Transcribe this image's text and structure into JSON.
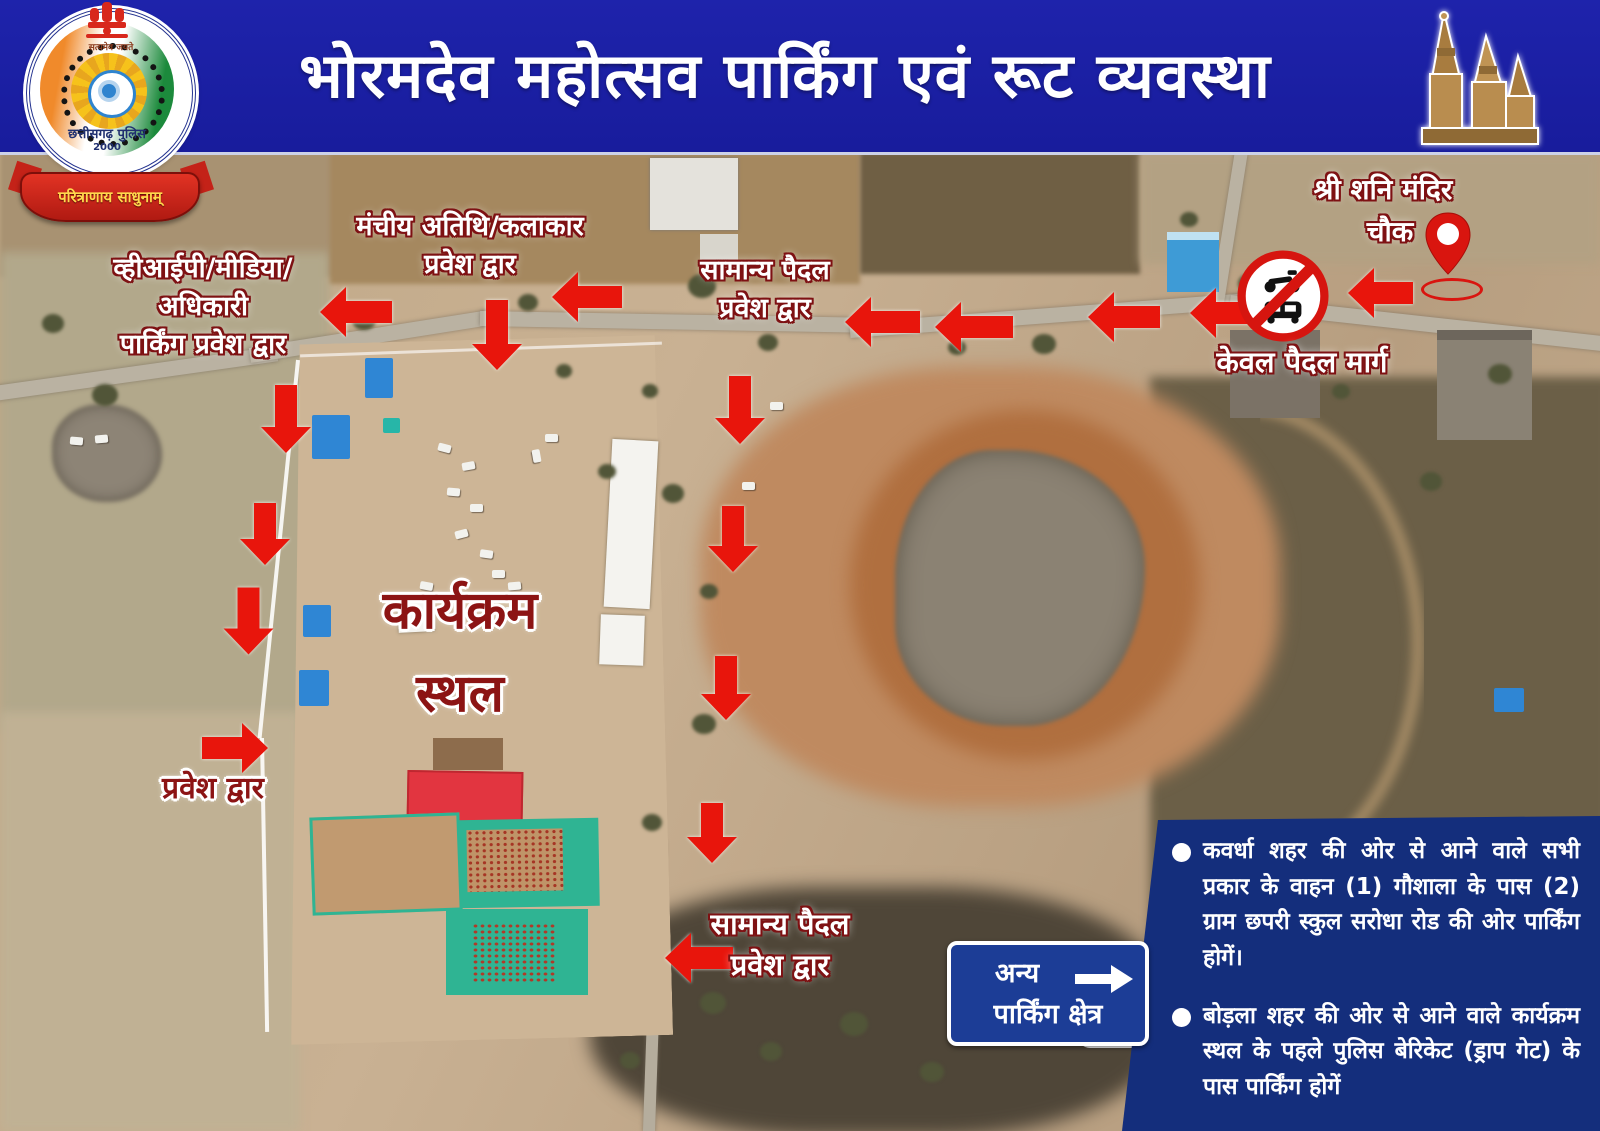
{
  "header": {
    "title": "भोरमदेव महोत्सव पार्किंग एवं रूट व्यवस्था"
  },
  "logo": {
    "motto_top": "सत्यमेव जयते",
    "org": "छत्तीसगढ़ पुलिस",
    "year": "2000",
    "ribbon": "परित्राणाय साधुनाम्"
  },
  "map_labels": {
    "shani_mandir": {
      "line1": "श्री शनि मंदिर",
      "line2": "चौक"
    },
    "pedestrian_only": "केवल पैदल मार्ग",
    "stage_guest_gate": {
      "line1": "मंचीय अतिथि/कलाकार",
      "line2": "प्रवेश द्वार"
    },
    "vip_parking_gate": {
      "line1": "व्हीआईपी/मीडिया/",
      "line2": "अधिकारी",
      "line3": "पार्किंग प्रवेश द्वार"
    },
    "general_pedestrian_gate_top": {
      "line1": "सामान्य पैदल",
      "line2": "प्रवेश द्वार"
    },
    "venue": {
      "line1": "कार्यक्रम",
      "line2": "स्थल"
    },
    "entry_gate": "प्रवेश द्वार",
    "general_pedestrian_gate_bottom": {
      "line1": "सामान्य पैदल",
      "line2": "प्रवेश द्वार"
    }
  },
  "other_parking_sign": {
    "line1": "अन्य",
    "line2": "पार्किंग क्षेत्र"
  },
  "info_panel": {
    "bullets": [
      "कवर्धा शहर की ओर से आने वाले सभी प्रकार के वाहन (1) गौशाला के पास (2) ग्राम छपरी स्कुल सरोधा रोड की ओर पार्किंग होगें।",
      "बोड़ला शहर की ओर से आने वाले कार्यक्रम स्थल के पहले पुलिस बेरिकेट (ड्राप गेट) के पास पार्किंग होगें"
    ]
  },
  "colors": {
    "header_blue": "#1c21a5",
    "arrow_red": "#e8150c",
    "panel_navy": "#142e7c",
    "sign_blue": "#1c3d96",
    "label_outline_maroon": "#7e1113"
  },
  "route_arrows": [
    {
      "cx": 356,
      "cy": 160,
      "len": 72,
      "dir": "left"
    },
    {
      "cx": 587,
      "cy": 145,
      "len": 70,
      "dir": "left"
    },
    {
      "cx": 882,
      "cy": 170,
      "len": 75,
      "dir": "left"
    },
    {
      "cx": 974,
      "cy": 175,
      "len": 78,
      "dir": "left"
    },
    {
      "cx": 1124,
      "cy": 165,
      "len": 72,
      "dir": "left"
    },
    {
      "cx": 1222,
      "cy": 161,
      "len": 65,
      "dir": "left"
    },
    {
      "cx": 1380,
      "cy": 141,
      "len": 65,
      "dir": "left"
    },
    {
      "cx": 699,
      "cy": 806,
      "len": 68,
      "dir": "left"
    },
    {
      "cx": 497,
      "cy": 183,
      "len": 70,
      "dir": "down"
    },
    {
      "cx": 286,
      "cy": 267,
      "len": 68,
      "dir": "down"
    },
    {
      "cx": 265,
      "cy": 382,
      "len": 62,
      "dir": "down"
    },
    {
      "cx": 248,
      "cy": 469,
      "len": 67,
      "dir": "down"
    },
    {
      "cx": 740,
      "cy": 258,
      "len": 68,
      "dir": "down"
    },
    {
      "cx": 733,
      "cy": 387,
      "len": 66,
      "dir": "down"
    },
    {
      "cx": 726,
      "cy": 536,
      "len": 64,
      "dir": "down"
    },
    {
      "cx": 712,
      "cy": 681,
      "len": 60,
      "dir": "down"
    },
    {
      "cx": 235,
      "cy": 596,
      "len": 66,
      "dir": "right"
    }
  ]
}
